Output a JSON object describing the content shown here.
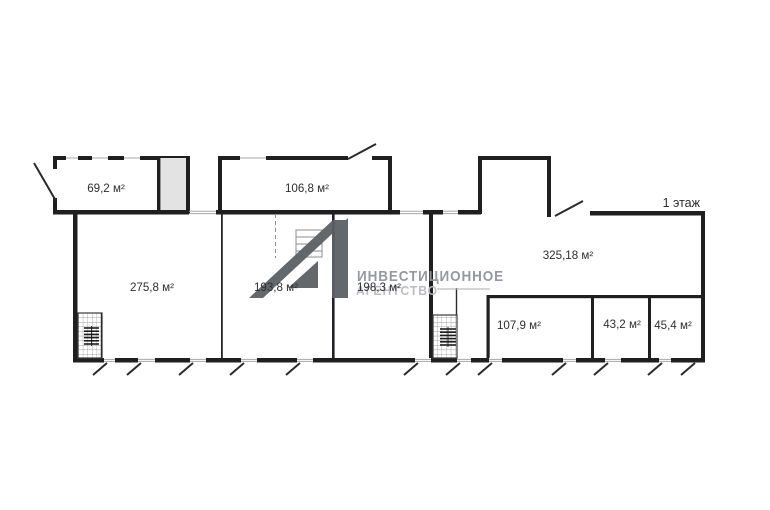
{
  "floor": {
    "label": "1 этаж"
  },
  "rooms": {
    "r69": "69,2 м²",
    "r106": "106,8 м²",
    "r275": "275,8 м²",
    "r193": "193,8 м²",
    "r198": "198,3 м²",
    "r325": "325,18 м²",
    "r107": "107,9 м²",
    "r43": "43,2 м²",
    "r45": "45,4 м²"
  },
  "watermark": {
    "line1": "ИНВЕСТИЦИОННОЕ",
    "line2": "АГЕНТСТВО"
  },
  "colors": {
    "background": "#ffffff",
    "wall": "#1f1f22",
    "shaft_fill": "#e3e3e3",
    "watermark_logo": "#5b6066",
    "watermark_text": "#8f939b",
    "watermark_text_light": "#b6b9bf",
    "label_text": "#2f2f31"
  }
}
